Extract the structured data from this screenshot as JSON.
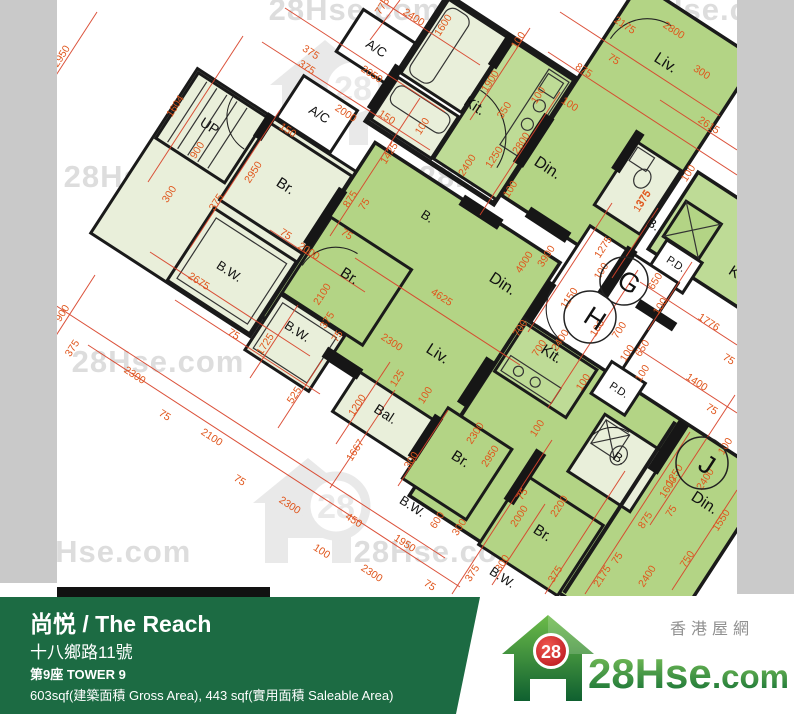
{
  "meta": {
    "width": 794,
    "height": 714
  },
  "colors": {
    "room_green": "#b3d485",
    "room_green2": "#bedb96",
    "room_pale": "#e9efda",
    "wall": "#1a1a1a",
    "dim_line": "#d8432a",
    "dim_text": "#e0561c",
    "watermark_gray": "#c9c9c9",
    "side_strip": "#c9c9c9",
    "footer_green": "#1c6b43",
    "logo_red": "#d71f26",
    "logo_green_dark": "#116e34",
    "logo_green_light": "#6cbb49",
    "tagline_gray": "#909090"
  },
  "floorplan": {
    "room_labels": [
      {
        "t": "UP",
        "x": 207,
        "y": 130,
        "s": 14
      },
      {
        "t": "A/C",
        "x": 374,
        "y": 52,
        "s": 13
      },
      {
        "t": "A/C",
        "x": 317,
        "y": 118,
        "s": 13
      },
      {
        "t": "Kit.",
        "x": 472,
        "y": 110,
        "s": 15
      },
      {
        "t": "Kit.",
        "x": 549,
        "y": 358,
        "s": 15
      },
      {
        "t": "Kit",
        "x": 735,
        "y": 278,
        "s": 15
      },
      {
        "t": "Liv.",
        "x": 663,
        "y": 67,
        "s": 16
      },
      {
        "t": "Liv.",
        "x": 435,
        "y": 358,
        "s": 16
      },
      {
        "t": "Din.",
        "x": 545,
        "y": 172,
        "s": 16
      },
      {
        "t": "Din.",
        "x": 500,
        "y": 288,
        "s": 16
      },
      {
        "t": "Din.",
        "x": 702,
        "y": 507,
        "s": 16
      },
      {
        "t": "Br.",
        "x": 283,
        "y": 190,
        "s": 15
      },
      {
        "t": "Br.",
        "x": 347,
        "y": 280,
        "s": 15
      },
      {
        "t": "Br.",
        "x": 458,
        "y": 463,
        "s": 15
      },
      {
        "t": "Br.",
        "x": 540,
        "y": 537,
        "s": 15
      },
      {
        "t": "B.W.",
        "x": 227,
        "y": 275,
        "s": 13
      },
      {
        "t": "B.W.",
        "x": 295,
        "y": 335,
        "s": 13
      },
      {
        "t": "B.W.",
        "x": 410,
        "y": 510,
        "s": 13
      },
      {
        "t": "B.W.",
        "x": 500,
        "y": 581,
        "s": 13
      },
      {
        "t": "Bal.",
        "x": 383,
        "y": 418,
        "s": 14
      },
      {
        "t": "B.",
        "x": 425,
        "y": 220,
        "s": 13
      },
      {
        "t": "B.",
        "x": 651,
        "y": 228,
        "s": 13
      },
      {
        "t": "B.",
        "x": 617,
        "y": 462,
        "s": 13
      },
      {
        "t": "P.D.",
        "x": 674,
        "y": 267,
        "s": 11
      },
      {
        "t": "P.D.",
        "x": 617,
        "y": 393,
        "s": 11
      }
    ],
    "units": [
      {
        "letter": "G",
        "x": 624,
        "y": 281,
        "r": 24
      },
      {
        "letter": "H",
        "x": 590,
        "y": 317,
        "r": 26
      },
      {
        "letter": "J",
        "x": 702,
        "y": 463,
        "r": 26
      }
    ],
    "dimensions": [
      {
        "v": "2950",
        "x": 64,
        "y": 58,
        "f": "B"
      },
      {
        "v": "1604",
        "x": 178,
        "y": 108,
        "f": "B"
      },
      {
        "v": "900",
        "x": 200,
        "y": 152,
        "f": "B"
      },
      {
        "v": "300",
        "x": 172,
        "y": 196,
        "f": "B"
      },
      {
        "v": "375",
        "x": 219,
        "y": 204,
        "f": "B"
      },
      {
        "v": "2950",
        "x": 256,
        "y": 174,
        "f": "B"
      },
      {
        "v": "775",
        "x": 385,
        "y": 8,
        "f": "B"
      },
      {
        "v": "2400",
        "x": 412,
        "y": 20,
        "f": "A"
      },
      {
        "v": "1600",
        "x": 446,
        "y": 27,
        "f": "B"
      },
      {
        "v": "375",
        "x": 309,
        "y": 55,
        "f": "A"
      },
      {
        "v": "375",
        "x": 305,
        "y": 70,
        "f": "A"
      },
      {
        "v": "2050",
        "x": 370,
        "y": 77,
        "f": "A"
      },
      {
        "v": "2000",
        "x": 344,
        "y": 116,
        "f": "A"
      },
      {
        "v": "150",
        "x": 286,
        "y": 133,
        "f": "A"
      },
      {
        "v": "150",
        "x": 385,
        "y": 120,
        "f": "A"
      },
      {
        "v": "1425",
        "x": 392,
        "y": 155,
        "f": "B"
      },
      {
        "v": "875",
        "x": 353,
        "y": 201,
        "f": "B"
      },
      {
        "v": "75",
        "x": 367,
        "y": 206,
        "f": "B"
      },
      {
        "v": "100",
        "x": 425,
        "y": 128,
        "f": "B"
      },
      {
        "v": "1900",
        "x": 493,
        "y": 83,
        "f": "B"
      },
      {
        "v": "100",
        "x": 521,
        "y": 42,
        "f": "B"
      },
      {
        "v": "350",
        "x": 507,
        "y": 112,
        "f": "B"
      },
      {
        "v": "100",
        "x": 541,
        "y": 97,
        "f": "B"
      },
      {
        "v": "2800",
        "x": 524,
        "y": 145,
        "f": "B"
      },
      {
        "v": "1250",
        "x": 497,
        "y": 159,
        "f": "B"
      },
      {
        "v": "2400",
        "x": 470,
        "y": 167,
        "f": "B"
      },
      {
        "v": "100",
        "x": 513,
        "y": 191,
        "f": "B"
      },
      {
        "v": "2175",
        "x": 623,
        "y": 28,
        "f": "A"
      },
      {
        "v": "2800",
        "x": 672,
        "y": 33,
        "f": "A"
      },
      {
        "v": "875",
        "x": 582,
        "y": 73,
        "f": "A"
      },
      {
        "v": "75",
        "x": 612,
        "y": 62,
        "f": "A"
      },
      {
        "v": "100",
        "x": 568,
        "y": 107,
        "f": "A"
      },
      {
        "v": "300",
        "x": 700,
        "y": 75,
        "f": "A"
      },
      {
        "v": "2615",
        "x": 707,
        "y": 128,
        "f": "A"
      },
      {
        "v": "100",
        "x": 691,
        "y": 175,
        "f": "B"
      },
      {
        "v": "375",
        "x": 646,
        "y": 200,
        "f": "B"
      },
      {
        "v": "4000",
        "x": 527,
        "y": 264,
        "f": "B"
      },
      {
        "v": "3900",
        "x": 549,
        "y": 258,
        "f": "B"
      },
      {
        "v": "1275",
        "x": 606,
        "y": 249,
        "f": "B"
      },
      {
        "v": "100",
        "x": 604,
        "y": 273,
        "f": "B"
      },
      {
        "v": "1375",
        "x": 645,
        "y": 203,
        "f": "B"
      },
      {
        "v": "1150",
        "x": 572,
        "y": 300,
        "f": "B"
      },
      {
        "v": "2400",
        "x": 563,
        "y": 342,
        "f": "B"
      },
      {
        "v": "100",
        "x": 600,
        "y": 330,
        "f": "B"
      },
      {
        "v": "700",
        "x": 622,
        "y": 332,
        "f": "B"
      },
      {
        "v": "100",
        "x": 630,
        "y": 355,
        "f": "B"
      },
      {
        "v": "650",
        "x": 645,
        "y": 350,
        "f": "B"
      },
      {
        "v": "100",
        "x": 645,
        "y": 375,
        "f": "B"
      },
      {
        "v": "100",
        "x": 586,
        "y": 384,
        "f": "B"
      },
      {
        "v": "650",
        "x": 658,
        "y": 283,
        "f": "B"
      },
      {
        "v": "100",
        "x": 663,
        "y": 308,
        "f": "B"
      },
      {
        "v": "1776",
        "x": 707,
        "y": 325,
        "f": "A"
      },
      {
        "v": "75",
        "x": 727,
        "y": 362,
        "f": "A"
      },
      {
        "v": "1400",
        "x": 695,
        "y": 385,
        "f": "A"
      },
      {
        "v": "75",
        "x": 710,
        "y": 412,
        "f": "A"
      },
      {
        "v": "100",
        "x": 728,
        "y": 448,
        "f": "B"
      },
      {
        "v": "75",
        "x": 284,
        "y": 237,
        "f": "A"
      },
      {
        "v": "2000",
        "x": 307,
        "y": 254,
        "f": "A"
      },
      {
        "v": "75",
        "x": 345,
        "y": 237,
        "f": "A"
      },
      {
        "v": "2100",
        "x": 325,
        "y": 296,
        "f": "B"
      },
      {
        "v": "375",
        "x": 330,
        "y": 322,
        "f": "B"
      },
      {
        "v": "75",
        "x": 340,
        "y": 338,
        "f": "B"
      },
      {
        "v": "4625",
        "x": 440,
        "y": 300,
        "f": "A"
      },
      {
        "v": "2300",
        "x": 390,
        "y": 345,
        "f": "A"
      },
      {
        "v": "125",
        "x": 400,
        "y": 380,
        "f": "B"
      },
      {
        "v": "100",
        "x": 428,
        "y": 397,
        "f": "B"
      },
      {
        "v": "700",
        "x": 523,
        "y": 330,
        "f": "B"
      },
      {
        "v": "700",
        "x": 542,
        "y": 350,
        "f": "B"
      },
      {
        "v": "900",
        "x": 65,
        "y": 315,
        "f": "B"
      },
      {
        "v": "375",
        "x": 75,
        "y": 350,
        "f": "B"
      },
      {
        "v": "2300",
        "x": 133,
        "y": 378,
        "f": "A"
      },
      {
        "v": "2675",
        "x": 197,
        "y": 284,
        "f": "A"
      },
      {
        "v": "75",
        "x": 232,
        "y": 337,
        "f": "A"
      },
      {
        "v": "1725",
        "x": 268,
        "y": 346,
        "f": "B"
      },
      {
        "v": "525",
        "x": 297,
        "y": 397,
        "f": "B"
      },
      {
        "v": "1200",
        "x": 360,
        "y": 407,
        "f": "B"
      },
      {
        "v": "1667",
        "x": 358,
        "y": 452,
        "f": "B"
      },
      {
        "v": "300",
        "x": 414,
        "y": 462,
        "f": "B"
      },
      {
        "v": "2100",
        "x": 210,
        "y": 440,
        "f": "A"
      },
      {
        "v": "75",
        "x": 163,
        "y": 418,
        "f": "A"
      },
      {
        "v": "75",
        "x": 238,
        "y": 483,
        "f": "A"
      },
      {
        "v": "2300",
        "x": 288,
        "y": 508,
        "f": "A"
      },
      {
        "v": "450",
        "x": 352,
        "y": 523,
        "f": "A"
      },
      {
        "v": "100",
        "x": 320,
        "y": 554,
        "f": "A"
      },
      {
        "v": "1950",
        "x": 403,
        "y": 546,
        "f": "A"
      },
      {
        "v": "2300",
        "x": 370,
        "y": 576,
        "f": "A"
      },
      {
        "v": "75",
        "x": 428,
        "y": 588,
        "f": "A"
      },
      {
        "v": "2300",
        "x": 478,
        "y": 435,
        "f": "B"
      },
      {
        "v": "2950",
        "x": 493,
        "y": 458,
        "f": "B"
      },
      {
        "v": "100",
        "x": 540,
        "y": 430,
        "f": "B"
      },
      {
        "v": "375",
        "x": 475,
        "y": 575,
        "f": "B"
      },
      {
        "v": "300",
        "x": 505,
        "y": 565,
        "f": "B"
      },
      {
        "v": "600",
        "x": 440,
        "y": 522,
        "f": "B"
      },
      {
        "v": "300",
        "x": 462,
        "y": 529,
        "f": "B"
      },
      {
        "v": "2000",
        "x": 522,
        "y": 518,
        "f": "B"
      },
      {
        "v": "2200",
        "x": 562,
        "y": 508,
        "f": "B"
      },
      {
        "v": "75",
        "x": 525,
        "y": 496,
        "f": "B"
      },
      {
        "v": "875",
        "x": 648,
        "y": 522,
        "f": "B"
      },
      {
        "v": "75",
        "x": 674,
        "y": 513,
        "f": "B"
      },
      {
        "v": "750",
        "x": 690,
        "y": 561,
        "f": "B"
      },
      {
        "v": "1550",
        "x": 724,
        "y": 522,
        "f": "B"
      },
      {
        "v": "2400",
        "x": 650,
        "y": 578,
        "f": "B"
      },
      {
        "v": "2175",
        "x": 605,
        "y": 578,
        "f": "B"
      },
      {
        "v": "75",
        "x": 620,
        "y": 560,
        "f": "B"
      },
      {
        "v": "375",
        "x": 558,
        "y": 576,
        "f": "B"
      },
      {
        "v": "1250",
        "x": 677,
        "y": 477,
        "f": "B"
      },
      {
        "v": "1600",
        "x": 671,
        "y": 489,
        "f": "B"
      },
      {
        "v": "2400",
        "x": 708,
        "y": 481,
        "f": "B"
      }
    ]
  },
  "watermarks": {
    "text": "28Hse.com",
    "logo_number": "28",
    "text_positions": [
      [
        355,
        8
      ],
      [
        710,
        8
      ],
      [
        150,
        175
      ],
      [
        505,
        175
      ],
      [
        158,
        360
      ],
      [
        475,
        358
      ],
      [
        105,
        550
      ],
      [
        440,
        550
      ]
    ],
    "logo_positions": [
      [
        335,
        100
      ],
      [
        330,
        300
      ],
      [
        318,
        518
      ]
    ]
  },
  "footer": {
    "title": "尚悦 / The Reach",
    "address": "十八鄉路11號",
    "tower": "第9座   TOWER 9",
    "area": "603sqf(建築面積 Gross Area), 443 sqf(實用面積 Saleable Area)"
  },
  "logo": {
    "number": "28",
    "name": "28Hse",
    "tld": ".com",
    "tagline": "香港屋網"
  }
}
